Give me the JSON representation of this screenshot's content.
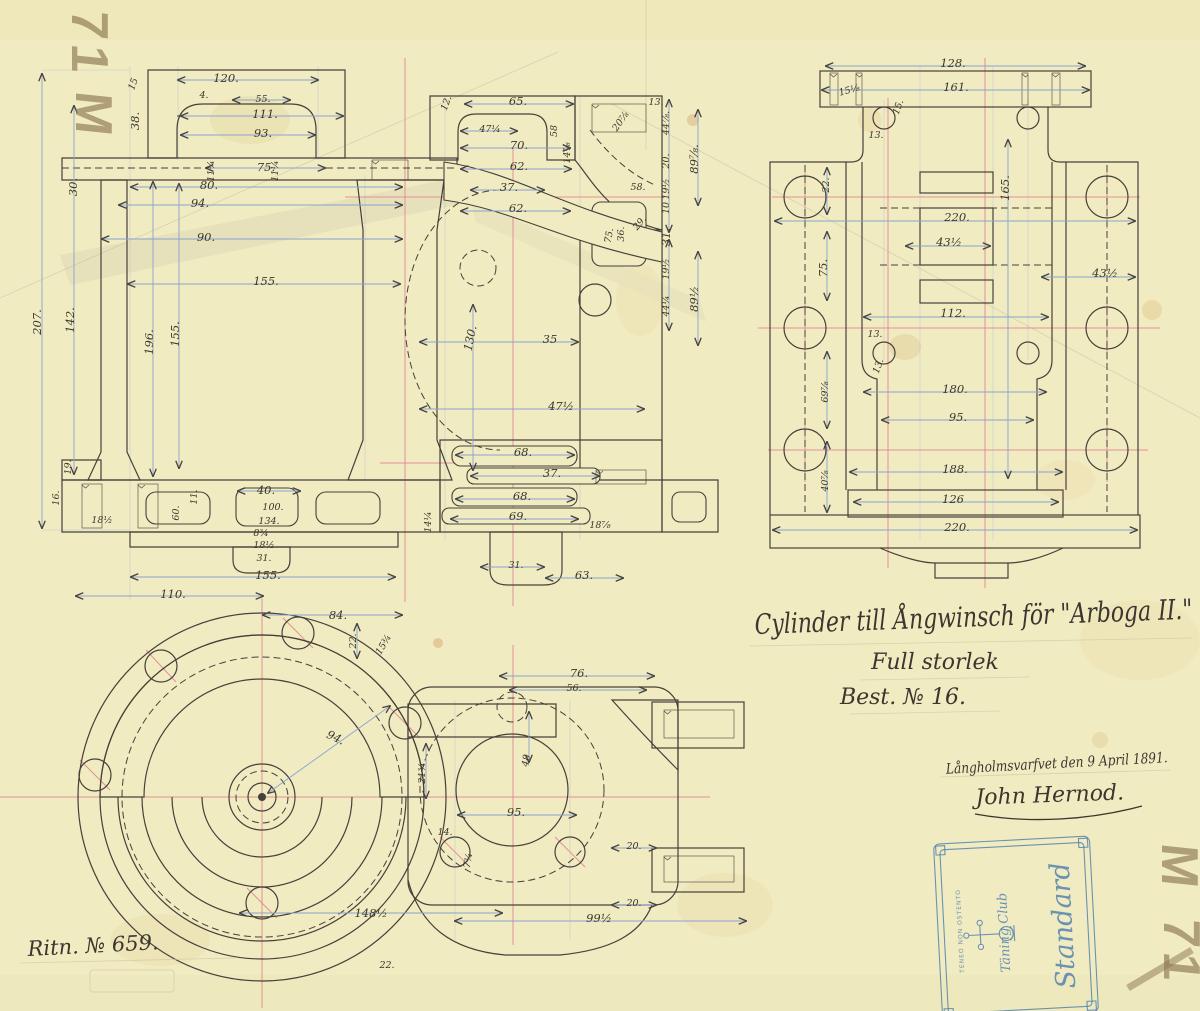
{
  "colors": {
    "paper": "#f1ebc2",
    "ink": "#46403a",
    "dimension_lines": "#87a4cf",
    "centerlines": "#e2808f",
    "stamp_blue": "#4a7cad",
    "pencil": "#8b7750"
  },
  "title_block": {
    "line1": "Cylinder till Ångwinsch för \"Arboga II.\"",
    "line2": "Full storlek",
    "line3": "Best. № 16."
  },
  "signature_block": {
    "place_date": "Långholmsvarfvet den 9 April 1891.",
    "name": "John Hernod."
  },
  "drawing_number": "Ritn. № 659.",
  "pencil_marks": {
    "top_left_digits": "71",
    "top_left_letter": "M",
    "bottom_right_letter": "M",
    "bottom_right_digits": "71"
  },
  "stamp": {
    "name_line1": "Standard",
    "name_line2": "Täning Club",
    "motto": "TENEO NON OSTENTO"
  },
  "views": {
    "section": {
      "label": "sectional elevation of cylinder",
      "dims": [
        {
          "t": "120.",
          "x": 226,
          "y": 82
        },
        {
          "t": "55.",
          "x": 263,
          "y": 102,
          "s": 1
        },
        {
          "t": "111.",
          "x": 265,
          "y": 118
        },
        {
          "t": "93.",
          "x": 263,
          "y": 137
        },
        {
          "t": "75.",
          "x": 266,
          "y": 171
        },
        {
          "t": "80.",
          "x": 209,
          "y": 189
        },
        {
          "t": "94.",
          "x": 200,
          "y": 207
        },
        {
          "t": "90.",
          "x": 206,
          "y": 241
        },
        {
          "t": "155.",
          "x": 266,
          "y": 285
        },
        {
          "t": "4.",
          "x": 204,
          "y": 98,
          "s": 1
        },
        {
          "t": "15",
          "x": 136,
          "y": 85,
          "r": -70,
          "s": 1
        },
        {
          "t": "38.",
          "x": 139,
          "y": 121,
          "r": -90
        },
        {
          "t": "30.",
          "x": 77,
          "y": 187,
          "r": -90
        },
        {
          "t": "207.",
          "x": 41,
          "y": 322,
          "r": -90
        },
        {
          "t": "142.",
          "x": 74,
          "y": 320,
          "r": -90
        },
        {
          "t": "196.",
          "x": 153,
          "y": 342,
          "r": -90
        },
        {
          "t": "155.",
          "x": 179,
          "y": 334,
          "r": -90
        },
        {
          "t": "19.",
          "x": 71,
          "y": 467,
          "r": -90,
          "s": 1
        },
        {
          "t": "16.",
          "x": 59,
          "y": 498,
          "r": -90,
          "s": 1
        },
        {
          "t": "11.",
          "x": 197,
          "y": 497,
          "r": -90,
          "s": 1
        },
        {
          "t": "60.",
          "x": 179,
          "y": 513,
          "r": -90,
          "s": 1
        },
        {
          "t": "18½",
          "x": 102,
          "y": 523,
          "s": 1
        },
        {
          "t": "14¼",
          "x": 431,
          "y": 522,
          "r": -90,
          "s": 1
        },
        {
          "t": "40.",
          "x": 266,
          "y": 494
        },
        {
          "t": "100.",
          "x": 273,
          "y": 510,
          "s": 1
        },
        {
          "t": "134.",
          "x": 269,
          "y": 524,
          "s": 1
        },
        {
          "t": "8¾",
          "x": 261,
          "y": 536,
          "s": 1
        },
        {
          "t": "18½",
          "x": 264,
          "y": 548,
          "s": 1
        },
        {
          "t": "31.",
          "x": 264,
          "y": 561,
          "s": 1
        },
        {
          "t": "155.",
          "x": 268,
          "y": 579
        },
        {
          "t": "110.",
          "x": 173,
          "y": 598
        },
        {
          "t": "11¼",
          "x": 214,
          "y": 171,
          "r": -90,
          "s": 1
        },
        {
          "t": "11¼",
          "x": 278,
          "y": 171,
          "r": -90,
          "s": 1
        },
        {
          "t": "12.",
          "x": 449,
          "y": 104,
          "r": -70,
          "s": 1
        },
        {
          "t": "65.",
          "x": 518,
          "y": 105
        },
        {
          "t": "47¼",
          "x": 490,
          "y": 132,
          "s": 1
        },
        {
          "t": "70.",
          "x": 519,
          "y": 149
        },
        {
          "t": "62.",
          "x": 519,
          "y": 170
        },
        {
          "t": "37.",
          "x": 509,
          "y": 191
        },
        {
          "t": "62.",
          "x": 518,
          "y": 212
        },
        {
          "t": "58",
          "x": 557,
          "y": 131,
          "r": -90,
          "s": 1
        },
        {
          "t": "14⅞",
          "x": 570,
          "y": 153,
          "r": -90,
          "s": 1
        },
        {
          "t": "20⅞",
          "x": 623,
          "y": 123,
          "r": -55,
          "s": 1
        },
        {
          "t": "13.",
          "x": 656,
          "y": 105,
          "s": 1
        },
        {
          "t": "44⅞.",
          "x": 669,
          "y": 123,
          "r": -90,
          "s": 1
        },
        {
          "t": "20.",
          "x": 669,
          "y": 161,
          "r": -90,
          "s": 1
        },
        {
          "t": "19½",
          "x": 669,
          "y": 189,
          "r": -90,
          "s": 1
        },
        {
          "t": "10",
          "x": 669,
          "y": 208,
          "r": -90,
          "s": 1
        },
        {
          "t": "31.",
          "x": 670,
          "y": 237,
          "r": -90
        },
        {
          "t": "19½",
          "x": 669,
          "y": 269,
          "r": -90,
          "s": 1
        },
        {
          "t": "44¼",
          "x": 669,
          "y": 306,
          "r": -90,
          "s": 1
        },
        {
          "t": "89⅞.",
          "x": 698,
          "y": 159,
          "r": -90
        },
        {
          "t": "89½",
          "x": 698,
          "y": 299,
          "r": -90
        },
        {
          "t": "58.",
          "x": 638,
          "y": 190,
          "s": 1
        },
        {
          "t": "29.",
          "x": 642,
          "y": 225,
          "r": -50,
          "s": 1
        },
        {
          "t": "75.",
          "x": 612,
          "y": 236,
          "r": -80,
          "s": 1
        },
        {
          "t": "36.",
          "x": 624,
          "y": 234,
          "r": -90,
          "s": 1
        },
        {
          "t": "130.",
          "x": 474,
          "y": 339,
          "r": -78
        },
        {
          "t": "35",
          "x": 550,
          "y": 343
        },
        {
          "t": "47½",
          "x": 561,
          "y": 410
        },
        {
          "t": "68.",
          "x": 523,
          "y": 456
        },
        {
          "t": "37.",
          "x": 552,
          "y": 477
        },
        {
          "t": "68.",
          "x": 522,
          "y": 500
        },
        {
          "t": "69.",
          "x": 518,
          "y": 520
        },
        {
          "t": "18⅞",
          "x": 600,
          "y": 528,
          "s": 1
        },
        {
          "t": "31.",
          "x": 516,
          "y": 568,
          "s": 1
        },
        {
          "t": "63.",
          "x": 584,
          "y": 579
        }
      ]
    },
    "plan": {
      "label": "plan view of cylinder",
      "dims": [
        {
          "t": "128.",
          "x": 953,
          "y": 67
        },
        {
          "t": "161.",
          "x": 956,
          "y": 91
        },
        {
          "t": "15⅛",
          "x": 850,
          "y": 93,
          "r": -15,
          "s": 1
        },
        {
          "t": "15.",
          "x": 901,
          "y": 108,
          "r": -70,
          "s": 1
        },
        {
          "t": "13.",
          "x": 876,
          "y": 138,
          "s": 1
        },
        {
          "t": "22.",
          "x": 829,
          "y": 185,
          "r": -90,
          "s": 1
        },
        {
          "t": "165.",
          "x": 1009,
          "y": 188,
          "r": -90
        },
        {
          "t": "220.",
          "x": 957,
          "y": 221
        },
        {
          "t": "43½",
          "x": 949,
          "y": 246
        },
        {
          "t": "75.",
          "x": 827,
          "y": 268,
          "r": -90
        },
        {
          "t": "43½",
          "x": 1105,
          "y": 277
        },
        {
          "t": "112.",
          "x": 953,
          "y": 317
        },
        {
          "t": "13.",
          "x": 875,
          "y": 337,
          "s": 1
        },
        {
          "t": "13.",
          "x": 881,
          "y": 367,
          "r": -70,
          "s": 1
        },
        {
          "t": "69⅞",
          "x": 828,
          "y": 392,
          "r": -90,
          "s": 1
        },
        {
          "t": "180.",
          "x": 955,
          "y": 393
        },
        {
          "t": "95.",
          "x": 958,
          "y": 421
        },
        {
          "t": "188.",
          "x": 955,
          "y": 473
        },
        {
          "t": "40⅞",
          "x": 828,
          "y": 481,
          "r": -90,
          "s": 1
        },
        {
          "t": "126",
          "x": 953,
          "y": 503
        },
        {
          "t": "220.",
          "x": 957,
          "y": 531
        }
      ]
    },
    "end": {
      "label": "end view of cylinder cover",
      "dims": [
        {
          "t": "84.",
          "x": 338,
          "y": 619
        },
        {
          "t": "22.",
          "x": 356,
          "y": 641,
          "r": -90,
          "s": 1
        },
        {
          "t": "15¾",
          "x": 386,
          "y": 646,
          "r": -60,
          "s": 1
        },
        {
          "t": "94.",
          "x": 334,
          "y": 741,
          "r": 25
        },
        {
          "t": "21¾",
          "x": 425,
          "y": 773,
          "r": -90,
          "s": 1
        },
        {
          "t": "148½",
          "x": 371,
          "y": 917
        },
        {
          "t": "22.",
          "x": 387,
          "y": 968,
          "s": 1
        },
        {
          "t": "76.",
          "x": 579,
          "y": 677
        },
        {
          "t": "56.",
          "x": 574,
          "y": 691,
          "s": 1
        },
        {
          "t": "48",
          "x": 529,
          "y": 761,
          "r": -80,
          "s": 1
        },
        {
          "t": "95.",
          "x": 516,
          "y": 816
        },
        {
          "t": "14.",
          "x": 445,
          "y": 835,
          "s": 1
        },
        {
          "t": "7¾",
          "x": 471,
          "y": 861,
          "r": -80,
          "s": 1
        },
        {
          "t": "20.",
          "x": 634,
          "y": 849,
          "s": 1
        },
        {
          "t": "20.",
          "x": 634,
          "y": 906,
          "s": 1
        },
        {
          "t": "99½",
          "x": 599,
          "y": 922
        }
      ]
    }
  }
}
